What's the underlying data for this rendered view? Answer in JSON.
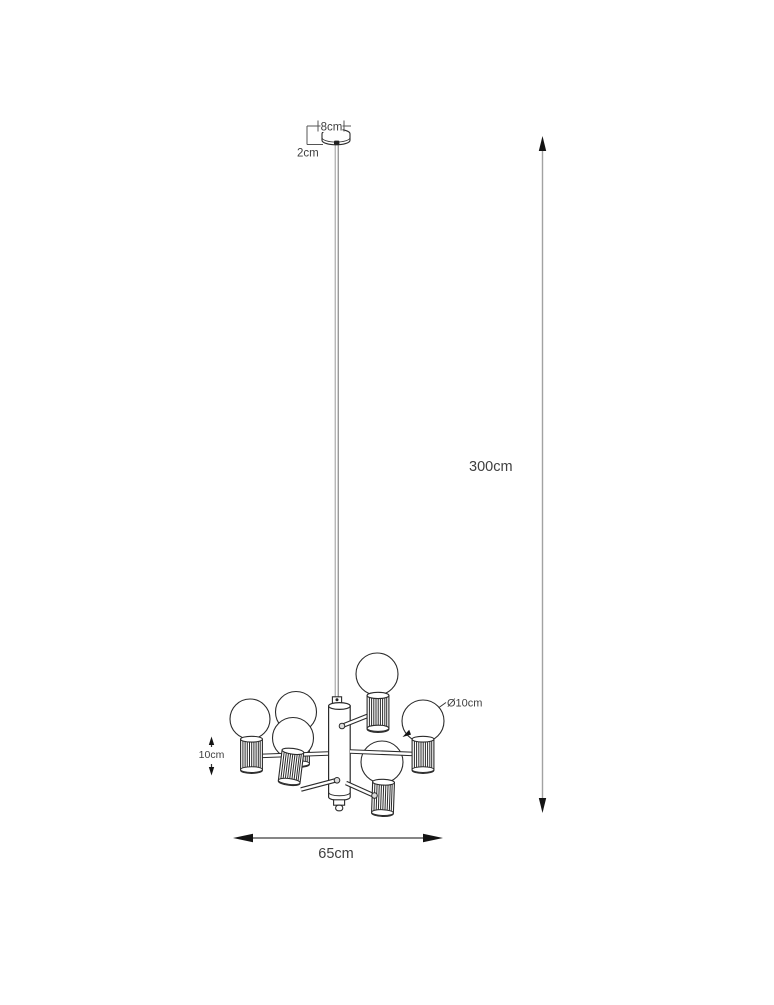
{
  "page": {
    "background": "#ffffff",
    "width_px": 774,
    "height_px": 1000
  },
  "drawing": {
    "subject": "six-arm chandelier pendant dimension drawing",
    "bulb_count": 6,
    "labels": {
      "canopy_width": "8cm",
      "canopy_height": "2cm",
      "suspension_length": "300cm",
      "bulb_diameter": "Ø10cm",
      "socket_height": "10cm",
      "fixture_width": "65cm"
    },
    "colors": {
      "outline": "#2b2b2b",
      "dimension_text": "#3f3f3f",
      "suspension_dim_line": "#a2a2a2",
      "width_dim_line": "#3d3d3d",
      "arrowhead": "#141414",
      "cord": "#9a9a9a"
    }
  }
}
